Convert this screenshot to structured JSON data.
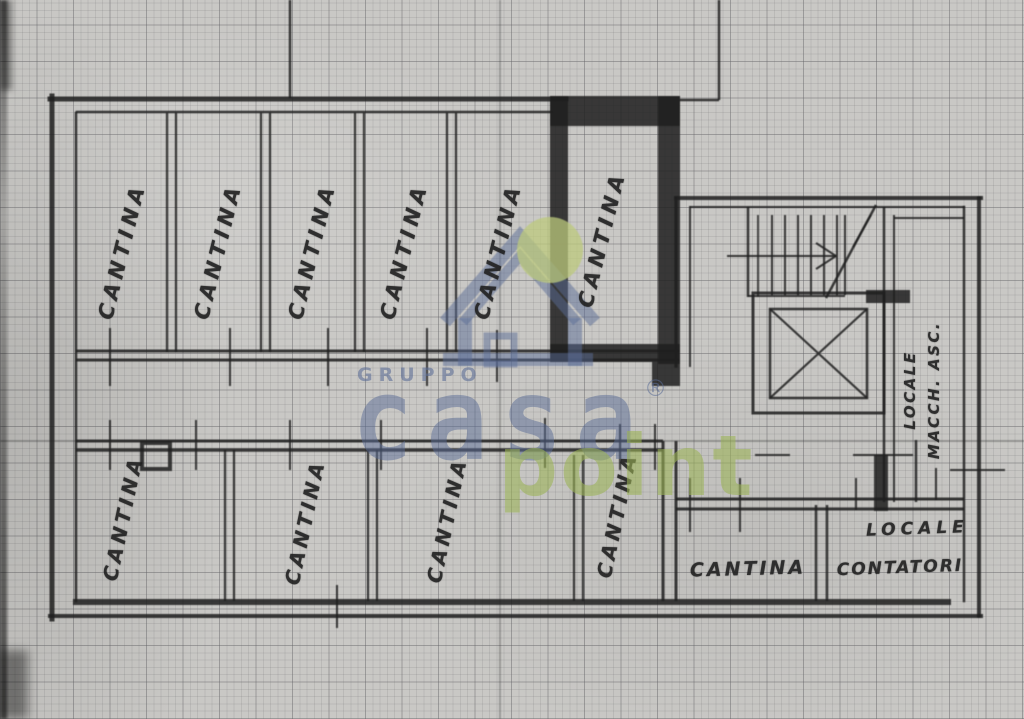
{
  "colors": {
    "ink": "#1f1f1f",
    "paper": "#c9c8c5",
    "watermark_blue": "#5a6c96",
    "watermark_green": "#9cb456",
    "watermark_circle": "#bcca7c"
  },
  "plan": {
    "top_row_labels": [
      "CANTINA",
      "CANTINA",
      "CANTINA",
      "CANTINA",
      "CANTINA",
      "CANTINA"
    ],
    "bottom_row_labels": [
      "CANTINA",
      "CANTINA",
      "CANTINA",
      "CANTINA"
    ],
    "bottom_right_room_label": "CANTINA",
    "meter_room_label": {
      "line1": "LOCALE",
      "line2": "CONTATORI"
    },
    "lift_machine_room_label": {
      "line1": "LOCALE",
      "line2": "MACCH. ASC."
    }
  },
  "watermark": {
    "gruppo": "GRUPPO",
    "casa": "casa",
    "registered": "®",
    "point": "point"
  }
}
